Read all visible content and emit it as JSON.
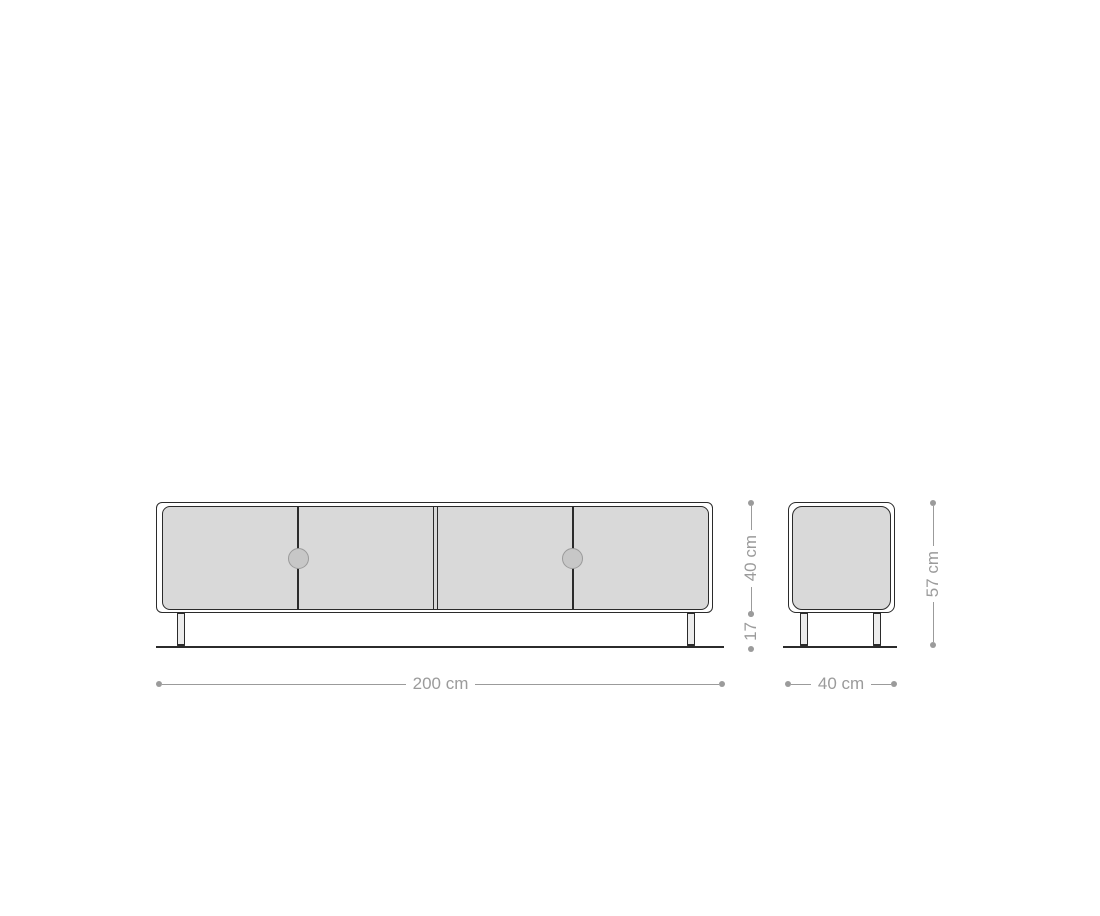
{
  "drawing": {
    "type": "furniture-dimension-diagram",
    "subject": "lowboard-sideboard",
    "views": {
      "front": {
        "door_count": 4,
        "handle_count": 2,
        "leg_count": 2
      },
      "side": {
        "leg_count": 2
      }
    },
    "dimensions": {
      "width": "200 cm",
      "depth": "40 cm",
      "body_height": "40 cm",
      "leg_height": "17",
      "total_height": "57 cm"
    }
  },
  "colors": {
    "outline": "#2b2b2b",
    "panel_fill": "#d9d9d9",
    "handle_fill": "#c7c7c7",
    "handle_border": "#9a9a9a",
    "dimension": "#9b9b9b",
    "background": "#ffffff"
  }
}
